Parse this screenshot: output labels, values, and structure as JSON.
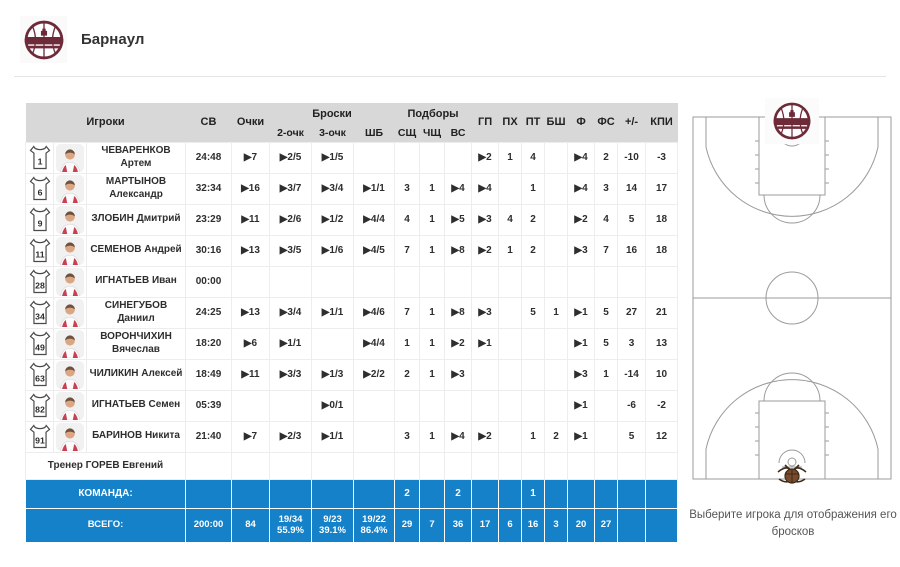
{
  "header": {
    "team_name": "Барнаул"
  },
  "table": {
    "columns": {
      "players": "Игроки",
      "sv": "СВ",
      "points": "Очки",
      "shots_group": "Броски",
      "two": "2-очк",
      "three": "3-очк",
      "ft": "ШБ",
      "rebounds_group": "Подборы",
      "osh": "СЩ",
      "dsh": "ЧЩ",
      "vs": "ВС",
      "gp": "ГП",
      "pkh": "ПХ",
      "pt": "ПТ",
      "bsh": "БШ",
      "f": "Ф",
      "fs": "ФС",
      "pm": "+/-",
      "kpi": "КПИ"
    },
    "players": [
      {
        "number": "1",
        "name": "ЧЕВАРЕНКОВ Артем",
        "stats": [
          "24:48",
          "▶7",
          "▶2/5",
          "▶1/5",
          "",
          "",
          "",
          "",
          "▶2",
          "1",
          "4",
          "",
          "▶4",
          "2",
          "-10",
          "-3"
        ]
      },
      {
        "number": "6",
        "name": "МАРТЫНОВ Александр",
        "stats": [
          "32:34",
          "▶16",
          "▶3/7",
          "▶3/4",
          "▶1/1",
          "3",
          "1",
          "▶4",
          "▶4",
          "",
          "1",
          "",
          "▶4",
          "3",
          "14",
          "17"
        ]
      },
      {
        "number": "9",
        "name": "ЗЛОБИН Дмитрий",
        "stats": [
          "23:29",
          "▶11",
          "▶2/6",
          "▶1/2",
          "▶4/4",
          "4",
          "1",
          "▶5",
          "▶3",
          "4",
          "2",
          "",
          "▶2",
          "4",
          "5",
          "18"
        ]
      },
      {
        "number": "11",
        "name": "СЕМЕНОВ Андрей",
        "stats": [
          "30:16",
          "▶13",
          "▶3/5",
          "▶1/6",
          "▶4/5",
          "7",
          "1",
          "▶8",
          "▶2",
          "1",
          "2",
          "",
          "▶3",
          "7",
          "16",
          "18"
        ]
      },
      {
        "number": "28",
        "name": "ИГНАТЬЕВ Иван",
        "stats": [
          "00:00",
          "",
          "",
          "",
          "",
          "",
          "",
          "",
          "",
          "",
          "",
          "",
          "",
          "",
          "",
          ""
        ]
      },
      {
        "number": "34",
        "name": "СИНЕГУБОВ Даниил",
        "stats": [
          "24:25",
          "▶13",
          "▶3/4",
          "▶1/1",
          "▶4/6",
          "7",
          "1",
          "▶8",
          "▶3",
          "",
          "5",
          "1",
          "▶1",
          "5",
          "27",
          "21"
        ]
      },
      {
        "number": "49",
        "name": "ВОРОНЧИХИН Вячеслав",
        "stats": [
          "18:20",
          "▶6",
          "▶1/1",
          "",
          "▶4/4",
          "1",
          "1",
          "▶2",
          "▶1",
          "",
          "",
          "",
          "▶1",
          "5",
          "3",
          "13"
        ]
      },
      {
        "number": "63",
        "name": "ЧИЛИКИН Алексей",
        "stats": [
          "18:49",
          "▶11",
          "▶3/3",
          "▶1/3",
          "▶2/2",
          "2",
          "1",
          "▶3",
          "",
          "",
          "",
          "",
          "▶3",
          "1",
          "-14",
          "10"
        ]
      },
      {
        "number": "82",
        "name": "ИГНАТЬЕВ Семен",
        "stats": [
          "05:39",
          "",
          "",
          "▶0/1",
          "",
          "",
          "",
          "",
          "",
          "",
          "",
          "",
          "▶1",
          "",
          "-6",
          "-2"
        ]
      },
      {
        "number": "91",
        "name": "БАРИНОВ Никита",
        "stats": [
          "21:40",
          "▶7",
          "▶2/3",
          "▶1/1",
          "",
          "3",
          "1",
          "▶4",
          "▶2",
          "",
          "1",
          "2",
          "▶1",
          "",
          "5",
          "12"
        ]
      }
    ],
    "coach_label": "Тренер ГОРЕВ Евгений",
    "team_row": {
      "label": "КОМАНДА:",
      "stats": [
        "",
        "",
        "",
        "",
        "",
        "2",
        "",
        "2",
        "",
        "",
        "1",
        "",
        "",
        "",
        "",
        ""
      ]
    },
    "totals_row": {
      "label": "ВСЕГО:",
      "stats": [
        "200:00",
        "84",
        "19/34\n55.9%",
        "9/23\n39.1%",
        "19/22\n86.4%",
        "29",
        "7",
        "36",
        "17",
        "6",
        "16",
        "3",
        "20",
        "27",
        "",
        ""
      ]
    }
  },
  "court": {
    "caption": "Выберите игрока для отображения его бросков"
  },
  "colors": {
    "accent_blue": "#1581c9",
    "header_gray": "#d8d8d8",
    "logo_maroon": "#6d2a39",
    "court_line": "#9b9b9b"
  }
}
